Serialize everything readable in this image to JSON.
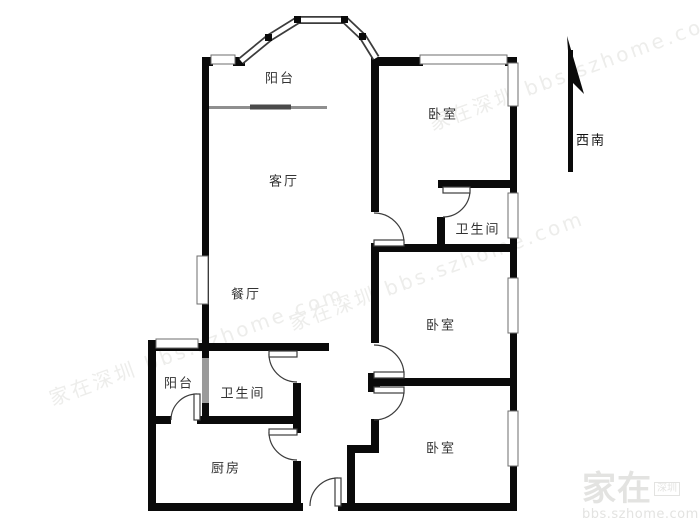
{
  "floorplan": {
    "rooms": {
      "balcony_top": {
        "label": "阳台"
      },
      "living": {
        "label": "客厅"
      },
      "dining": {
        "label": "餐厅"
      },
      "bedroom_top": {
        "label": "卧室"
      },
      "bath_top": {
        "label": "卫生间"
      },
      "bedroom_mid": {
        "label": "卧室"
      },
      "bedroom_bot": {
        "label": "卧室"
      },
      "balcony_small": {
        "label": "阳台"
      },
      "bath_small": {
        "label": "卫生间"
      },
      "kitchen": {
        "label": "厨房"
      }
    },
    "compass": {
      "label": "西南"
    },
    "watermark": {
      "brand": "家在",
      "city": "深圳",
      "site": "bbs.szhome.com",
      "ghost": "家在深圳 bbs.szhome.com"
    },
    "colors": {
      "wall": "#0a0a0a",
      "window_frame": "#6e6e6e",
      "gray_divider": "#9a9a9a",
      "label": "#333333",
      "watermark": "#e3e3e1"
    }
  }
}
